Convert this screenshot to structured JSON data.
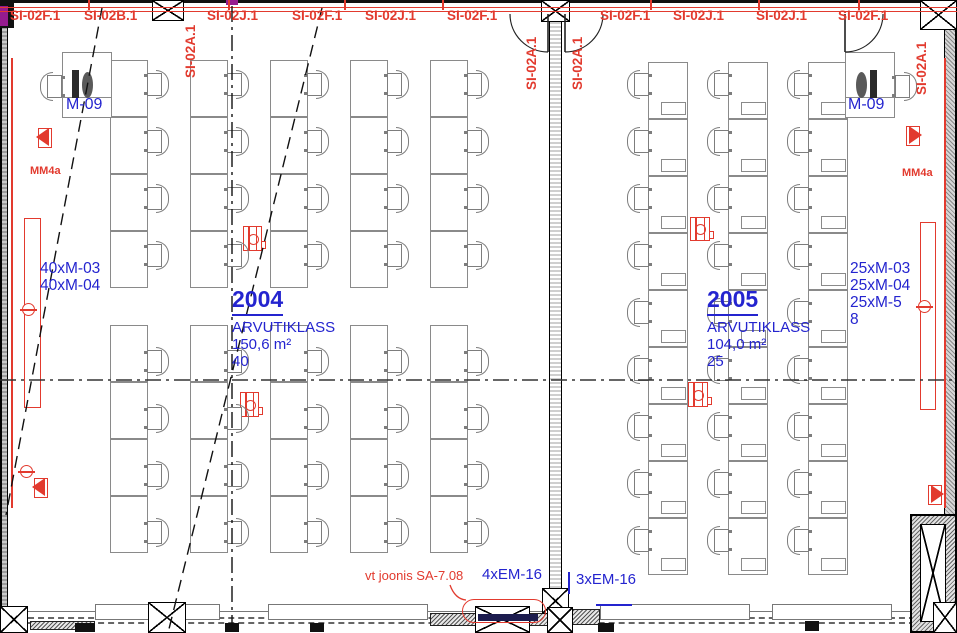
{
  "colors": {
    "accent_red": "#e23a2e",
    "accent_blue": "#2424cf",
    "navy_bar": "#1c1c4e",
    "magenta_mark": "#951b8f"
  },
  "fire_alarm": {
    "labels": [
      "SI-02F.1",
      "SI-02B.1",
      "SI-02A.1",
      "SI-02J.1",
      "SI-02F.1",
      "SI-02J.1",
      "SI-02F.1",
      "SI-02A.1",
      "SI-02A.1",
      "SI-02F.1",
      "SI-02J.1",
      "SI-02J.1",
      "SI-02F.1",
      "SI-02A.1"
    ]
  },
  "rooms": [
    {
      "number": "2004",
      "name": "ARVUTIKLASS",
      "area": "150,6 m²",
      "capacity": "40",
      "teacher_station": "M-09",
      "equipment": [
        "40xM-03",
        "40xM-04"
      ]
    },
    {
      "number": "2005",
      "name": "ARVUTIKLASS",
      "area": "104,0 m²",
      "capacity": "25",
      "teacher_station": "M-09",
      "equipment": [
        "25xM-03",
        "25xM-04",
        "25xM-5",
        "8"
      ]
    }
  ],
  "wall_labels": {
    "left": "MM4a",
    "right": "MM4a"
  },
  "notes": {
    "reference": "vt joonis SA-7.08",
    "em_left": "4xEM-16",
    "em_right": "3xEM-16"
  }
}
